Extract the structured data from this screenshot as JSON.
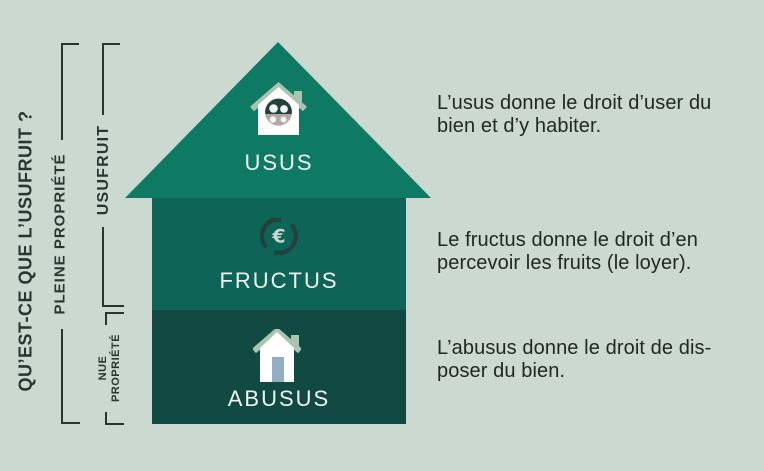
{
  "title": {
    "text": "QU’EST-CE QUE L’USUFRUIT ?"
  },
  "left_labels": {
    "pleine_propriete": "PLEINE PROPRIÉTÉ",
    "usufruit": "USUFRUIT",
    "nue_line1": "NUE",
    "nue_line2": "PROPRIÉTÉ"
  },
  "house": {
    "usus": {
      "label": "USUS",
      "icon": "family-house-icon"
    },
    "fructus": {
      "label": "FRUCTUS",
      "icon": "euro-cycle-icon"
    },
    "abusus": {
      "label": "ABUSUS",
      "icon": "house-icon"
    }
  },
  "descriptions": {
    "usus": {
      "line1": "L’usus donne le droit d’user du",
      "line2": "bien et d’y habiter."
    },
    "fructus": {
      "line1": "Le fructus donne le droit d’en",
      "line2": "percevoir les fruits (le loyer)."
    },
    "abusus": {
      "line1": "L’abusus donne le droit de dis-",
      "line2": "poser du bien."
    }
  },
  "palette": {
    "background": "#ccd9d0",
    "roof_green": "#0e7a64",
    "fructus_green": "#0e6557",
    "abusus_green": "#114a42",
    "sage_accent": "#a9c4af",
    "door_blue": "#93aec3",
    "dark_text": "#2a3531",
    "light_text": "#eef3f0"
  }
}
